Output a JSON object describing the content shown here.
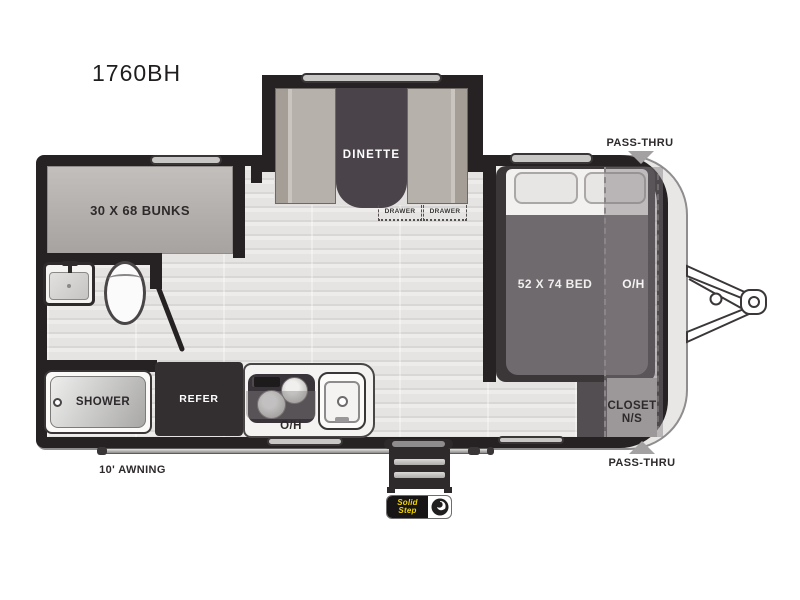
{
  "title": "1760BH",
  "areas": {
    "bunks": {
      "label": "30 X 68 BUNKS"
    },
    "dinette": {
      "label": "DINETTE",
      "drawers": [
        "DRAWER",
        "DRAWER"
      ]
    },
    "bed": {
      "label": "52 X 74 BED",
      "overhead": "O/H"
    },
    "closet": {
      "line1": "CLOSET",
      "line2": "N/S"
    },
    "kitchen": {
      "refer": "REFER",
      "overhead": "O/H"
    },
    "bath": {
      "shower": "SHOWER"
    }
  },
  "exterior": {
    "pass_thru_top": "PASS-THRU",
    "pass_thru_bottom": "PASS-THRU",
    "awning": "10' AWNING",
    "step_logo_line1": "Solid",
    "step_logo_line2": "Step"
  },
  "colors": {
    "wall": "#262223",
    "floor": "#e8e6e4",
    "bunks_fill": "#b5b1af",
    "bench_fill": "#b7b1ab",
    "table_fill": "#4a434a",
    "bed_frame": "#3b3739",
    "mattress": "#6f6a6e",
    "overhead_overlay": "rgba(128,123,126,0.45)",
    "arrow_gray": "#a3a1a2",
    "refer_fill": "#332f31",
    "logo_yellow": "#f2d600"
  }
}
